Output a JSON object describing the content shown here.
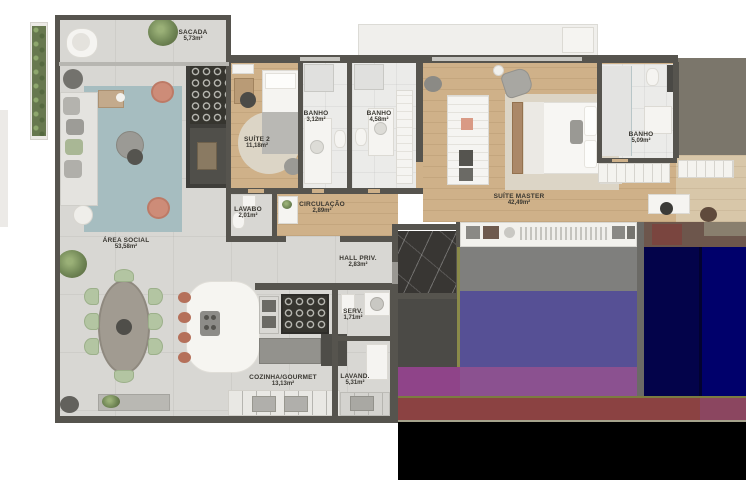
{
  "plan": {
    "title": "apartment-floor-plan",
    "rooms": [
      {
        "id": "sacada",
        "name": "SACADA",
        "area": "5,73m²"
      },
      {
        "id": "area-social",
        "name": "ÁREA SOCIAL",
        "area": "53,58m²"
      },
      {
        "id": "suite-2",
        "name": "SUÍTE 2",
        "area": "11,18m²"
      },
      {
        "id": "banho-suite-2",
        "name": "BANHO",
        "area": "3,12m²"
      },
      {
        "id": "banho-social",
        "name": "BANHO",
        "area": "4,58m²"
      },
      {
        "id": "lavabo",
        "name": "LAVABO",
        "area": "2,01m²"
      },
      {
        "id": "circulacao",
        "name": "CIRCULAÇÃO",
        "area": "2,89m²"
      },
      {
        "id": "hall-priv",
        "name": "HALL PRIV.",
        "area": "2,83m²"
      },
      {
        "id": "suite-master",
        "name": "SUÍTE MASTER",
        "area": "42,49m²"
      },
      {
        "id": "banho-master",
        "name": "BANHO",
        "area": "5,09m²"
      },
      {
        "id": "serv",
        "name": "SERV.",
        "area": "1,71m²"
      },
      {
        "id": "cozinha-gourmet",
        "name": "COZINHA/GOURMET",
        "area": "13,13m²"
      },
      {
        "id": "lavand",
        "name": "LAVAND.",
        "area": "5,31m²"
      }
    ],
    "colors": {
      "wall": "#56544e",
      "concrete": "#d8d7d3",
      "wood": "#cfb189",
      "woodlight": "#d8c7a9",
      "bath": "#ebebe9",
      "marble": "#383633",
      "rugblue": "#a6bdc0",
      "rugbeige": "#dcd5c6",
      "terracotta": "#cd8c78",
      "chairgreen": "#b3c5a2",
      "labelink": "#383630",
      "glitchgray": "#7f7f7d",
      "glitchpurple": "#565095",
      "glitchmagenta": "#8b5190",
      "glitchmagenta2": "#8f4489",
      "glitchnavy1": "#03034a",
      "glitchnavy2": "#00006b",
      "glitchmaroon": "#8b4242",
      "glitchbrown": "#6d564c",
      "glitcholive": "#7c7c40",
      "glitchblack": "#000000"
    }
  }
}
